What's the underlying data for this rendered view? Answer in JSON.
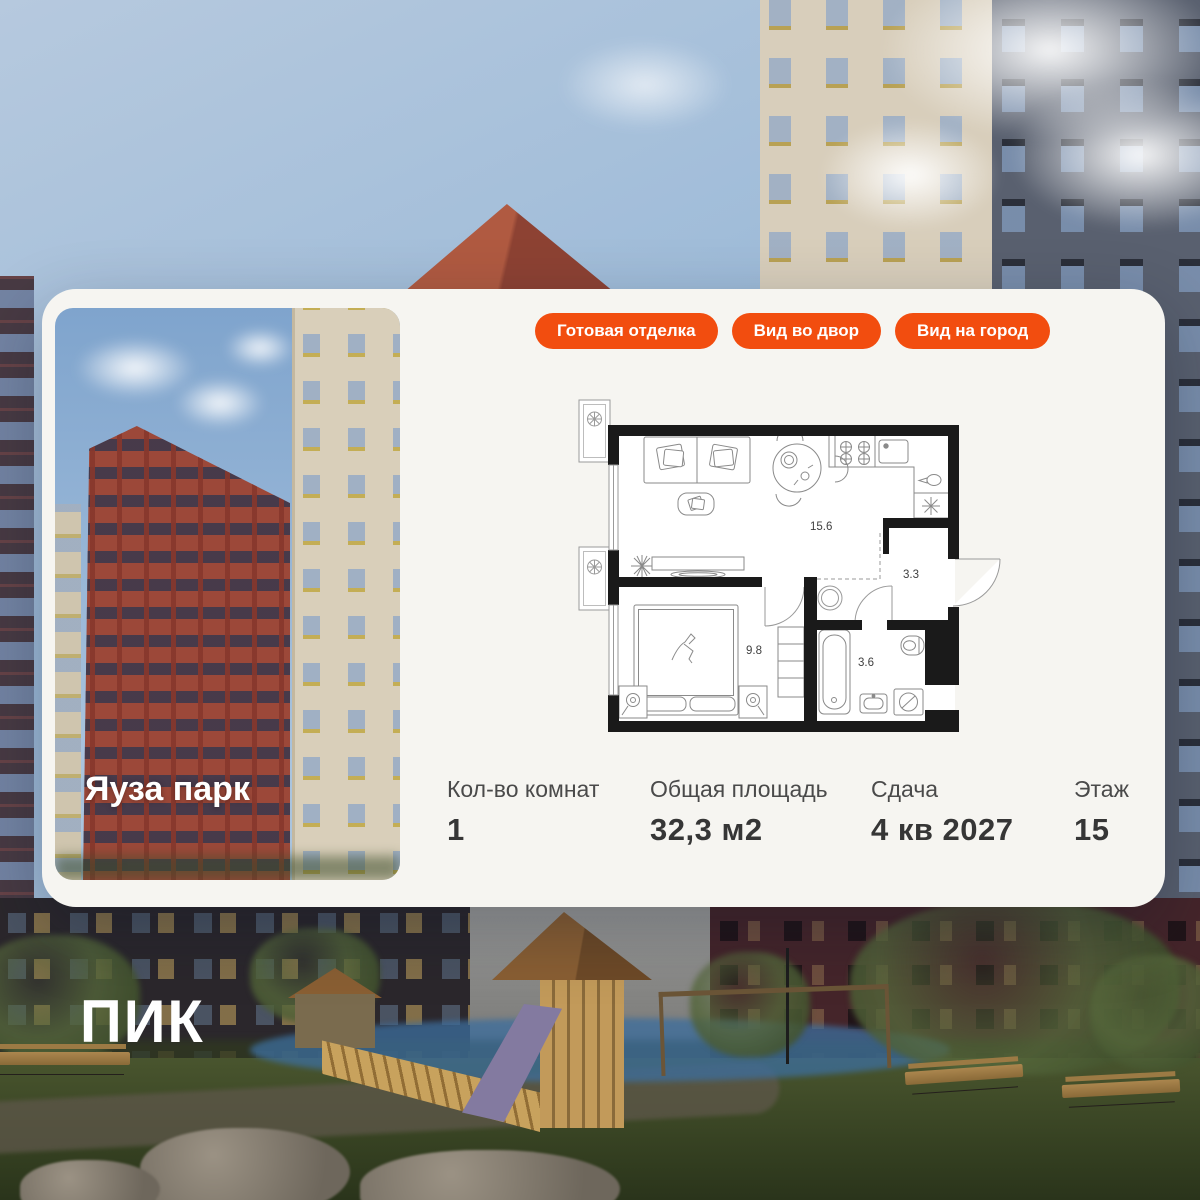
{
  "brand": {
    "logo": "ПИК"
  },
  "card": {
    "badges": [
      {
        "label": "Готовая отделка"
      },
      {
        "label": "Вид во двор"
      },
      {
        "label": "Вид на город"
      }
    ],
    "photo": {
      "title": "Яуза парк"
    },
    "plan": {
      "rooms": [
        {
          "area": "15.6"
        },
        {
          "area": "3.3"
        },
        {
          "area": "9.8"
        },
        {
          "area": "3.6"
        }
      ]
    },
    "stats": [
      {
        "label": "Кол-во комнат",
        "value": "1"
      },
      {
        "label": "Общая площадь",
        "value": "32,3 м2"
      },
      {
        "label": "Сдача",
        "value": "4 кв 2027"
      },
      {
        "label": "Этаж",
        "value": "15"
      }
    ],
    "colors": {
      "accent": "#F24D0F",
      "card_bg": "#F6F5F1"
    }
  }
}
